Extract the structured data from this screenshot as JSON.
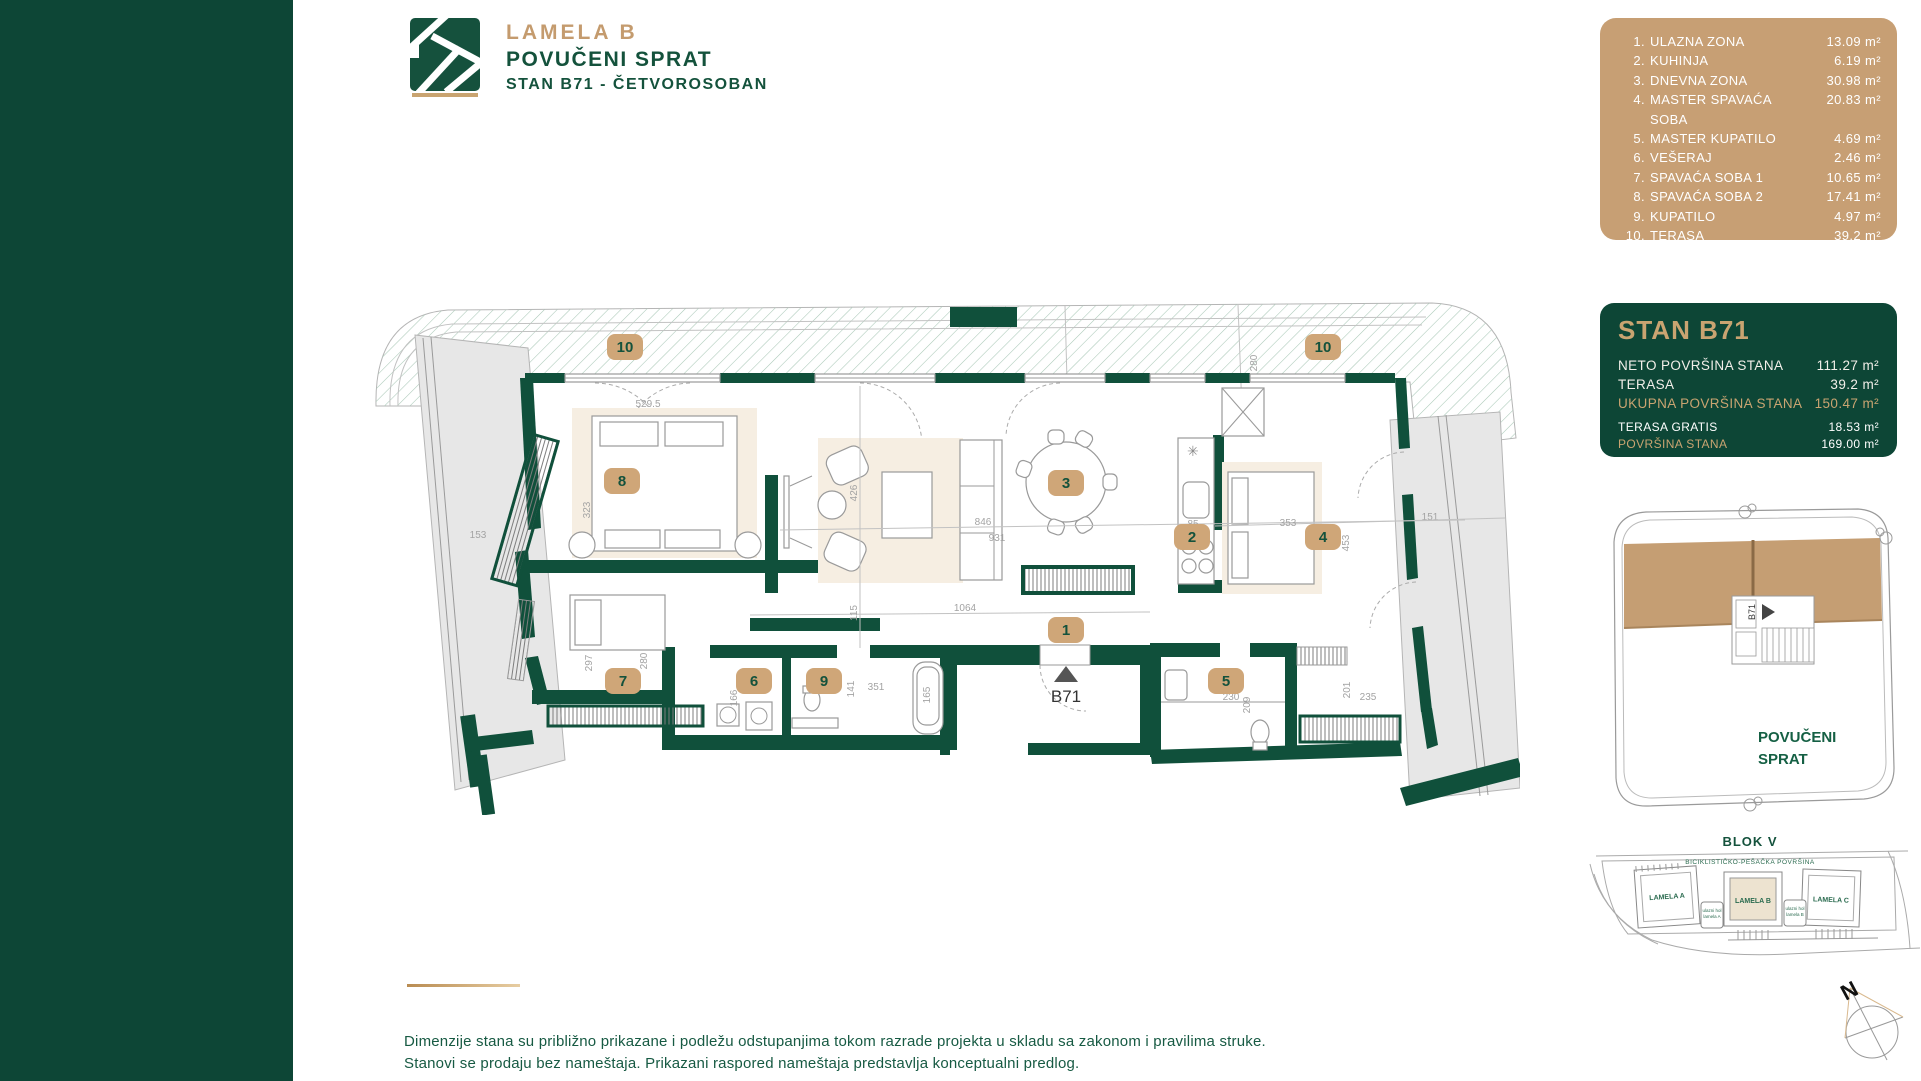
{
  "header": {
    "brand": "LAMELA B",
    "floor": "POVUČENI SPRAT",
    "unit": "STAN B71 - ČETVOROSOBAN"
  },
  "room_list": {
    "items": [
      {
        "num": "1.",
        "name": "ULAZNA ZONA",
        "area": "13.09 m²"
      },
      {
        "num": "2.",
        "name": "KUHINJA",
        "area": "6.19 m²"
      },
      {
        "num": "3.",
        "name": "DNEVNA ZONA",
        "area": "30.98 m²"
      },
      {
        "num": "4.",
        "name": "MASTER SPAVAĆA SOBA",
        "area": "20.83 m²"
      },
      {
        "num": "5.",
        "name": "MASTER KUPATILO",
        "area": "4.69 m²"
      },
      {
        "num": "6.",
        "name": "VEŠERAJ",
        "area": "2.46 m²"
      },
      {
        "num": "7.",
        "name": "SPAVAĆA SOBA 1",
        "area": "10.65 m²"
      },
      {
        "num": "8.",
        "name": "SPAVAĆA SOBA 2",
        "area": "17.41 m²"
      },
      {
        "num": "9.",
        "name": "KUPATILO",
        "area": "4.97 m²"
      },
      {
        "num": "10.",
        "name": "TERASA",
        "area": "39.2 m²"
      }
    ]
  },
  "summary": {
    "title": "STAN B71",
    "rows": [
      {
        "label": "NETO POVRŠINA STANA",
        "value": "111.27 m²"
      },
      {
        "label": "TERASA",
        "value": "39.2 m²"
      },
      {
        "label": "UKUPNA POVRŠINA STANA",
        "value": "150.47 m²"
      },
      {
        "label": "TERASA GRATIS",
        "value": "18.53 m²"
      },
      {
        "label": "POVRŠINA STANA",
        "value": "169.00 m²"
      }
    ]
  },
  "plan": {
    "unit_marker": "B71",
    "badges": {
      "entry": "1",
      "kitchen": "2",
      "living": "3",
      "master": "4",
      "master_bath": "5",
      "laundry": "6",
      "bed1": "7",
      "bed2": "8",
      "bath": "9",
      "terrace_left": "10",
      "terrace_right": "10"
    },
    "dims": {
      "terrace_depth": "240",
      "terrace_right_depth": "280",
      "left_terrace": "153",
      "r8_width": "529.5",
      "r8_depth": "323",
      "living_w1": "846",
      "living_w2": "931",
      "living_h": "426",
      "corridor_h": "115",
      "hall_width": "1064",
      "r7_depth": "297",
      "r7_width": "280",
      "laundry_w": "166",
      "bath9_w": "351",
      "bath9_h": "141",
      "tub_l": "165",
      "kitchen_w": "85",
      "r4_width": "353",
      "r4_depth": "453",
      "right_terrace": "151",
      "bath5_w": "230",
      "bath5_h": "209",
      "hall2_h": "201",
      "hall2_w": "235"
    }
  },
  "key_plan": {
    "unit_label": "B71",
    "floor_line1": "POVUČENI",
    "floor_line2": "SPRAT"
  },
  "site_plan": {
    "title": "BLOK V",
    "path_label": "BICIKLISTIČKO-PEŠAČKA POVRŠINA",
    "building_a": "LAMELA A",
    "building_b": "LAMELA B",
    "building_c": "LAMELA C",
    "entrance_left_1": "ulazni hol",
    "entrance_left_2": "lamela A",
    "entrance_right_1": "ulazni hol",
    "entrance_right_2": "lamela B"
  },
  "compass": {
    "north_label": "N"
  },
  "disclaimer": {
    "line1": "Dimenzije stana su približno prikazane i podležu odstupanjima tokom razrade projekta u skladu sa zakonom i pravilima struke.",
    "line2": "Stanovi se prodaju bez nameštaja. Prikazani raspored nameštaja predstavlja konceptualni predlog."
  },
  "colors": {
    "brand_green": "#0d4636",
    "wall_green": "#10503b",
    "brand_tan": "#c79f74",
    "gold_text": "#c9a471",
    "hatch_green": "#a9c8b7"
  }
}
